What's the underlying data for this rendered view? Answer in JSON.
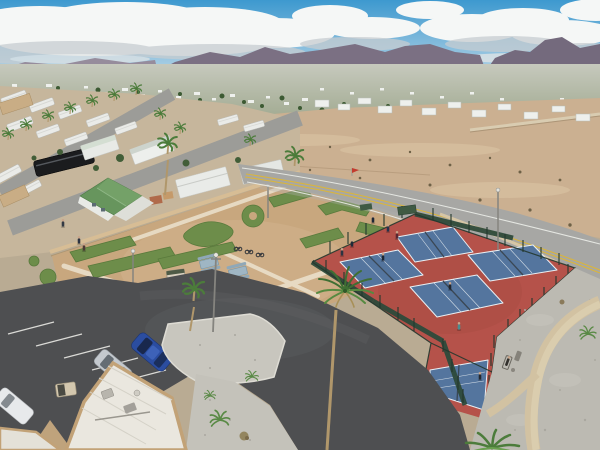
{
  "scene": {
    "title": "Aerial drone photo of a desert RV resort recreation area",
    "description": "Drone view of an RV park with a miniature golf course and four fenced pickleball courts beside a two-lane highway, desert lots and a mobile-home town stretching to a mountain range under a partly cloudy sky",
    "features": [
      "partly-cloudy-sky",
      "mountain-range",
      "mobile-home-town",
      "vacant-desert-lot",
      "two-lane-highway",
      "rv-park-streets",
      "green-roof-house",
      "mini-golf-course",
      "pickleball-courts",
      "curving-park-road",
      "parking-lot",
      "flat-roof-building",
      "palm-trees",
      "gravel-landscaping"
    ],
    "counts": {
      "pickleball_courts_visible": 5,
      "players_on_courts": 9,
      "parked_cars": 3,
      "picnic_tables": 2,
      "mini_golf_greens_visible": 10
    }
  },
  "colors": {
    "sky_top": "#3d99cf",
    "sky_horizon": "#c6dce9",
    "cloud_white": "#f5f7f6",
    "cloud_shadow": "#c7cdd1",
    "mountain_far": "#968c9c",
    "mountain_main": "#7b7083",
    "mountain_right": "#746a7d",
    "haze": "#bdbfb7",
    "town_base": "#bfc4b4",
    "town_home": "#eef0ed",
    "town_tree": "#3c5a33",
    "desert_sand": "#cbb091",
    "desert_light": "#dac4a4",
    "desert_shrub": "#6e6147",
    "retaining_wall": "#d9ccb1",
    "highway_asphalt": "#a7a7a4",
    "lane_yellow": "#d9b53e",
    "lane_white": "#eceee9",
    "park_ground": "#c6b69c",
    "park_road": "#9c9c98",
    "rv_white": "#eaebe8",
    "shed_tan": "#c9ad85",
    "bus_black": "#1b1c1e",
    "wall_tan": "#d7bd95",
    "house_roof_green": "#67955d",
    "house_wall": "#e8eae6",
    "golf_sand": "#c8a77e",
    "golf_turf": "#6d8d4a",
    "golf_turf_dark": "#597a3c",
    "golf_path": "#eadfca",
    "court_red": "#b5524a",
    "court_red_dark": "#a34840",
    "court_blue": "#54759e",
    "court_line": "#e9eff3",
    "net_dark": "#3a4754",
    "fence_wind": "#2e4a3b",
    "fence_post": "#24382e",
    "gravel": "#bcbab2",
    "gravel_light": "#c8c6be",
    "gravel_path": "#d2c2a2",
    "loop_asphalt": "#4e4f51",
    "stall_white": "#dadad6",
    "roof_white": "#eae7df",
    "roof_trim": "#c2a277",
    "palm_green": "#4c7c3b",
    "palm_trunk": "#b0976b",
    "car_blue": "#2b4da0",
    "car_silver": "#c4c9ce",
    "car_white": "#e7e9eb",
    "table_blue": "#9fb6c4",
    "cone_orange": "#e07b28",
    "flag_red": "#c23b2e",
    "lamp_gray": "#85847f",
    "person_dark": "#242b36",
    "person_teal": "#4a8d90",
    "skin": "#c9a489"
  }
}
